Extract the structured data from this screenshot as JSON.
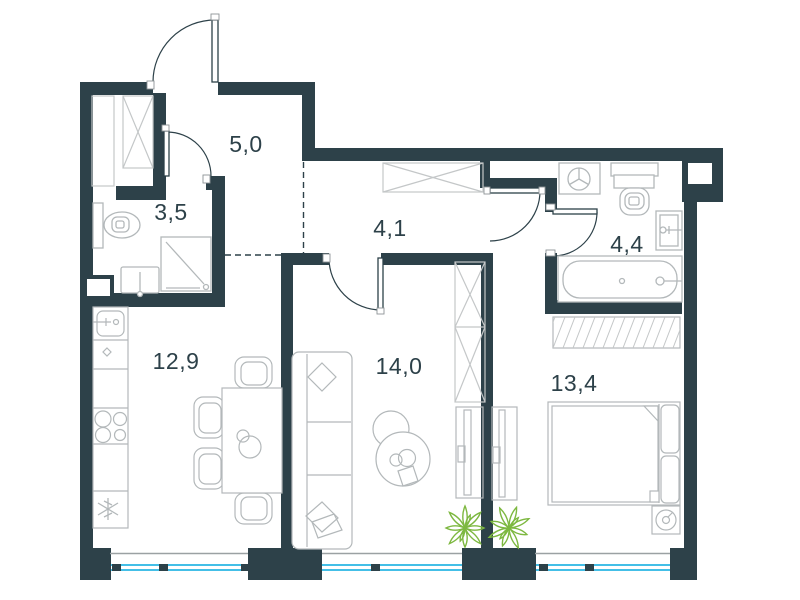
{
  "plan": {
    "rooms": [
      {
        "name": "entry-hall",
        "area_label": "5,0"
      },
      {
        "name": "bathroom",
        "area_label": "3,5"
      },
      {
        "name": "corridor",
        "area_label": "4,1"
      },
      {
        "name": "ensuite-bathroom",
        "area_label": "4,4"
      },
      {
        "name": "kitchen-dining",
        "area_label": "12,9"
      },
      {
        "name": "living-room",
        "area_label": "14,0"
      },
      {
        "name": "bedroom",
        "area_label": "13,4"
      }
    ],
    "colors": {
      "wall": "#2d4149",
      "furniture_line": "#b3b8ba",
      "hatch_line": "#c4c7c8",
      "window_glass": "#44bfe7",
      "window_sill": "#9ba1a3",
      "plant": "#7db840",
      "background": "#ffffff"
    },
    "icons": [
      "entry-door-arc",
      "bathroom-door-arc",
      "living-room-door-arc",
      "bedroom-door-arc",
      "ensuite-door-arc",
      "wardrobe-x-icon",
      "hatch-wardrobe-icon",
      "toilet-icon",
      "shower-icon",
      "sink-icon",
      "washing-machine-icon",
      "bathtub-icon",
      "stove-icon",
      "fridge-snowflake-icon",
      "kitchen-sink-icon",
      "dining-table-icon",
      "chair-icon",
      "sofa-icon",
      "coffee-table-icon",
      "tv-panel-icon",
      "double-bed-icon",
      "plant-icon",
      "window-icon"
    ]
  }
}
